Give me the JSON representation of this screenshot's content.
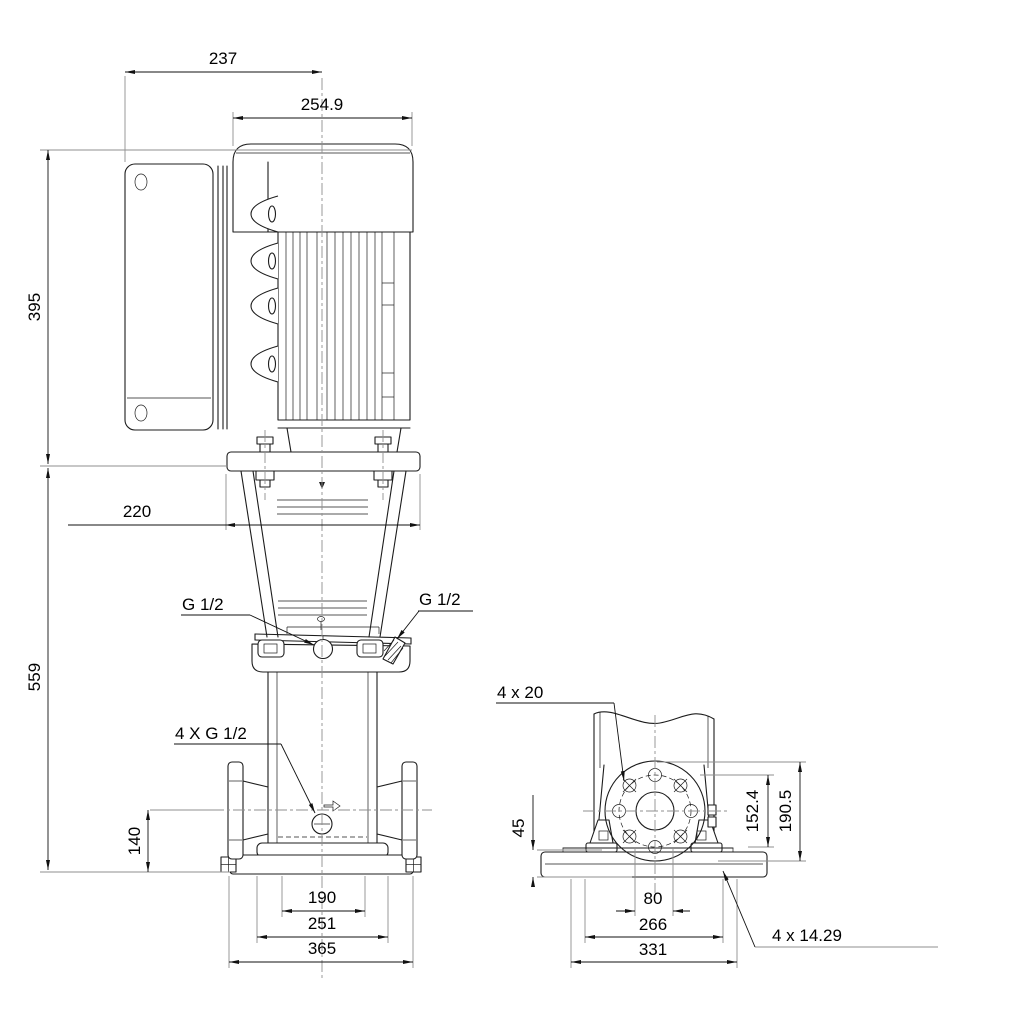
{
  "drawing": {
    "type": "pump-dimensional-drawing",
    "front_view": {
      "dim_width_top": "237",
      "dim_motor_width": "254.9",
      "dim_motor_height": "395",
      "dim_coupling_width": "220",
      "dim_pump_height": "559",
      "dim_port_centerline_height": "140",
      "dim_base_width_inner": "190",
      "dim_base_width_mid": "251",
      "dim_base_width_outer": "365",
      "label_port_left": "G 1/2",
      "label_port_right": "G 1/2",
      "label_plug_ports": "4 X G 1/2"
    },
    "side_view": {
      "label_flange_bolt_holes": "4 x 20",
      "dim_base_height": "45",
      "dim_bolt_circle_diameter": "152.4",
      "dim_flange_diameter": "190.5",
      "dim_bolt_hole_spacing": "80",
      "dim_base_depth_mid": "266",
      "dim_base_depth_outer": "331",
      "label_base_bolt_holes": "4 x 14.29"
    },
    "colors": {
      "line": "#1c1c1c",
      "dimension": "#111111",
      "extension": "#8f8f8f",
      "background": "#ffffff"
    }
  }
}
